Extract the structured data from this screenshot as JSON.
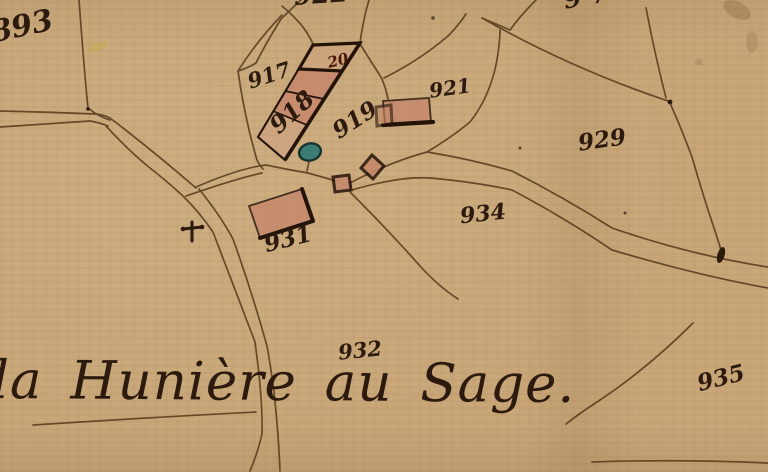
{
  "document_type": "hand-drawn cadastral map scan",
  "title": {
    "text": "la Hunière au Sage."
  },
  "labels": [
    {
      "name": "893",
      "text": "893",
      "x": 22,
      "y": 27,
      "size": 30,
      "rot": -12
    },
    {
      "name": "922",
      "text": "922",
      "x": 321,
      "y": -5,
      "size": 26,
      "rot": -4
    },
    {
      "name": "97",
      "text": "9 7",
      "x": 586,
      "y": -3,
      "size": 26,
      "rot": -10
    },
    {
      "name": "917",
      "text": "917",
      "x": 269,
      "y": 75,
      "size": 21,
      "rot": -18
    },
    {
      "name": "20",
      "text": "20",
      "x": 338,
      "y": 61,
      "size": 15,
      "rot": -14,
      "color": "#4a1408"
    },
    {
      "name": "918",
      "text": "918",
      "x": 292,
      "y": 112,
      "size": 24,
      "rot": -42
    },
    {
      "name": "919",
      "text": "919",
      "x": 355,
      "y": 120,
      "size": 23,
      "rot": -33
    },
    {
      "name": "921",
      "text": "921",
      "x": 450,
      "y": 88,
      "size": 20,
      "rot": -8
    },
    {
      "name": "929",
      "text": "929",
      "x": 602,
      "y": 140,
      "size": 23,
      "rot": -8
    },
    {
      "name": "934",
      "text": "934",
      "x": 483,
      "y": 214,
      "size": 22,
      "rot": -6
    },
    {
      "name": "931",
      "text": "931",
      "x": 288,
      "y": 239,
      "size": 23,
      "rot": -14
    },
    {
      "name": "932",
      "text": "932",
      "x": 360,
      "y": 350,
      "size": 21,
      "rot": -6
    },
    {
      "name": "935",
      "text": "935",
      "x": 721,
      "y": 378,
      "size": 23,
      "rot": -14
    }
  ],
  "features": [
    "long-farm-building-row-parcels-917-918-with-unit-20",
    "building-at-parcel-921",
    "small-diamond-building",
    "small-square-building",
    "building-at-parcel-931",
    "pond",
    "wayside-cross",
    "roads-and-parcel-boundaries",
    "ink-blot-on-road",
    "stains-top-right"
  ],
  "colors": {
    "paper": "#c8a678",
    "ink": "#2b1a0d",
    "line": "#5d4122",
    "building_fill": "#c5876b",
    "building_fill_light": "#cfa183",
    "building_stroke": "#241309",
    "pond_fill": "#3d7c74",
    "pond_stroke": "#17332e",
    "unit20_label": "#4a1408"
  }
}
